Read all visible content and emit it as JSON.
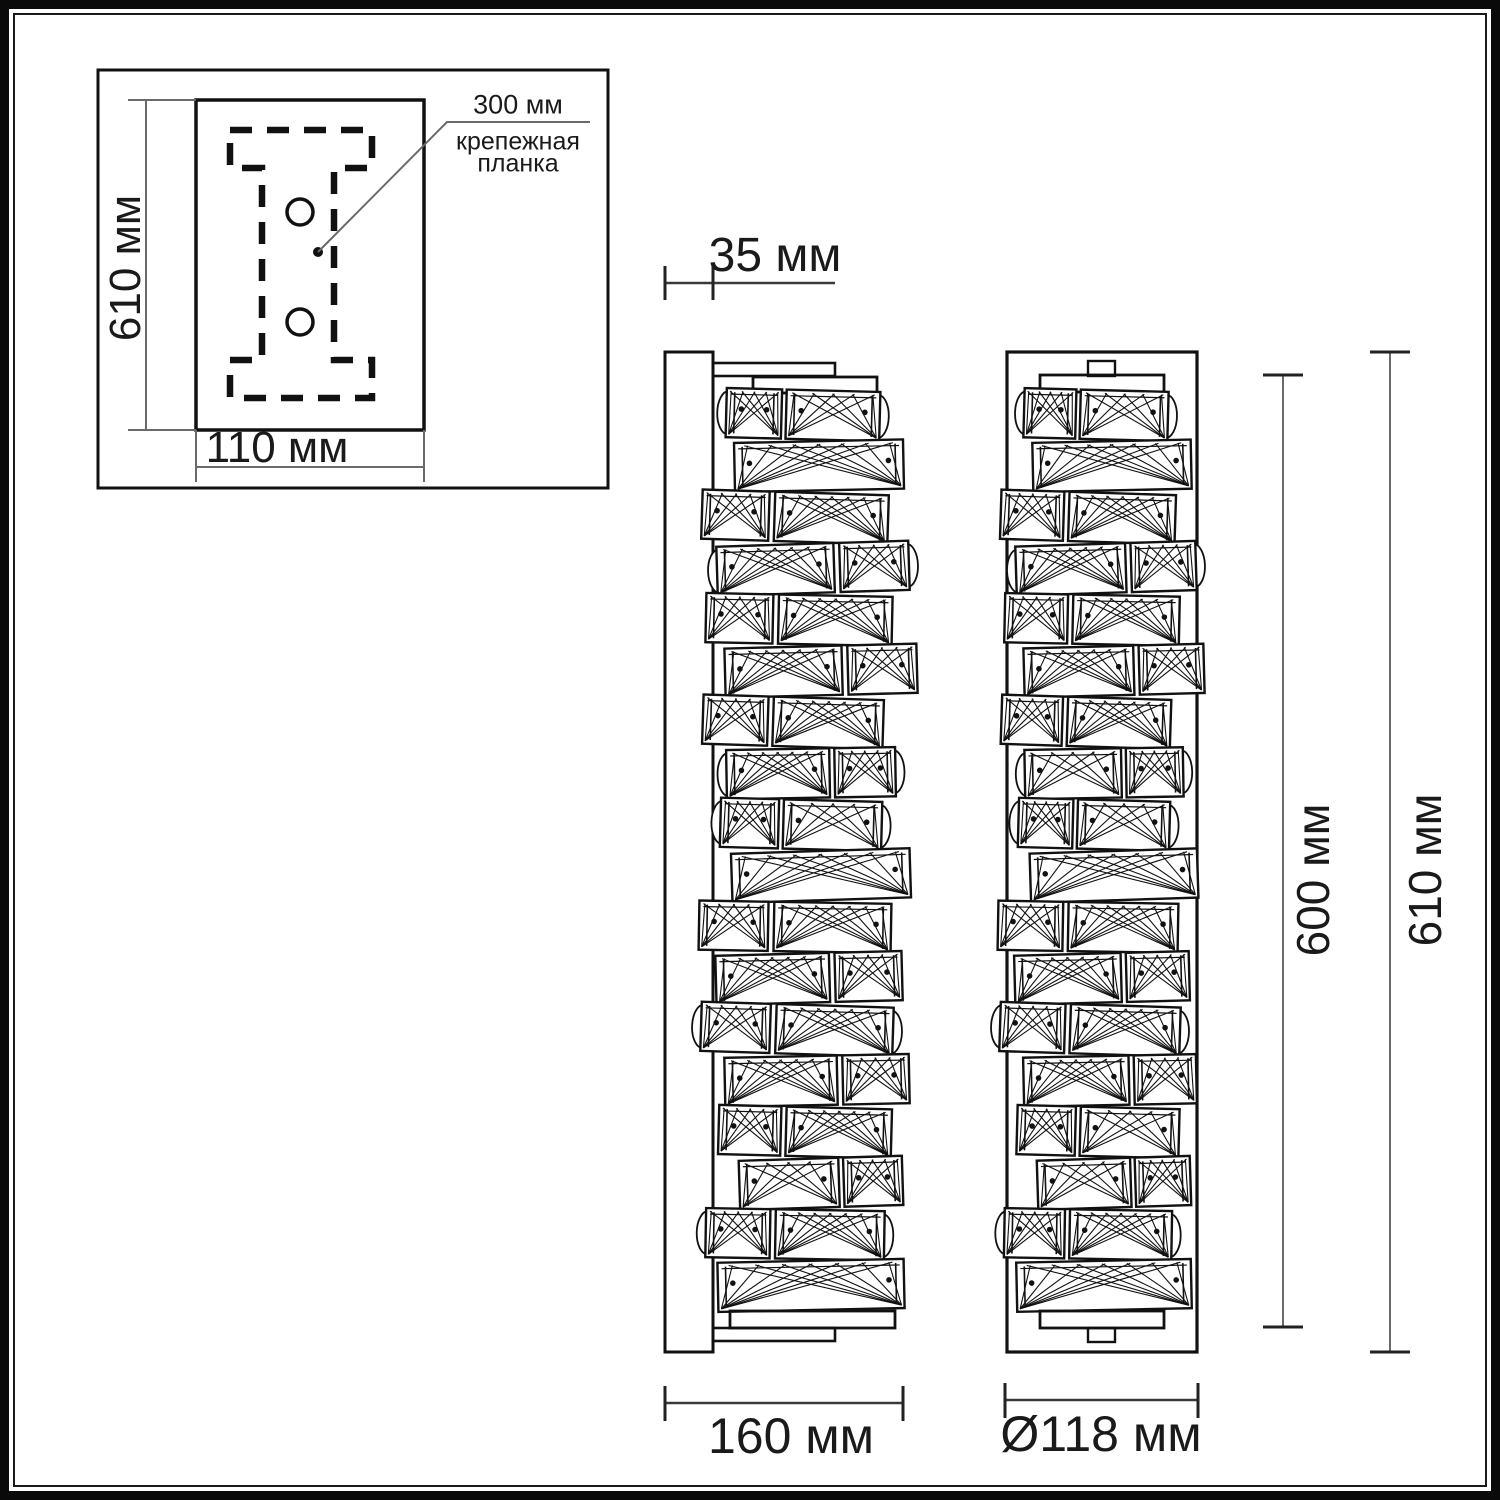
{
  "colors": {
    "background": "#ffffff",
    "line": "#111111",
    "dim_line": "#666666",
    "text": "#1a1a1a"
  },
  "mounting_inset": {
    "height_label": "610 мм",
    "width_label": "110 мм",
    "callout": {
      "dimension": "300 мм",
      "name_line1": "крепежная",
      "name_line2": "планка"
    }
  },
  "side_view": {
    "depth_label": "35 мм",
    "width_label": "160 мм"
  },
  "front_view": {
    "diameter_label": "Ø118 мм",
    "lamp_height_label": "600 мм",
    "total_height_label": "610 мм"
  }
}
